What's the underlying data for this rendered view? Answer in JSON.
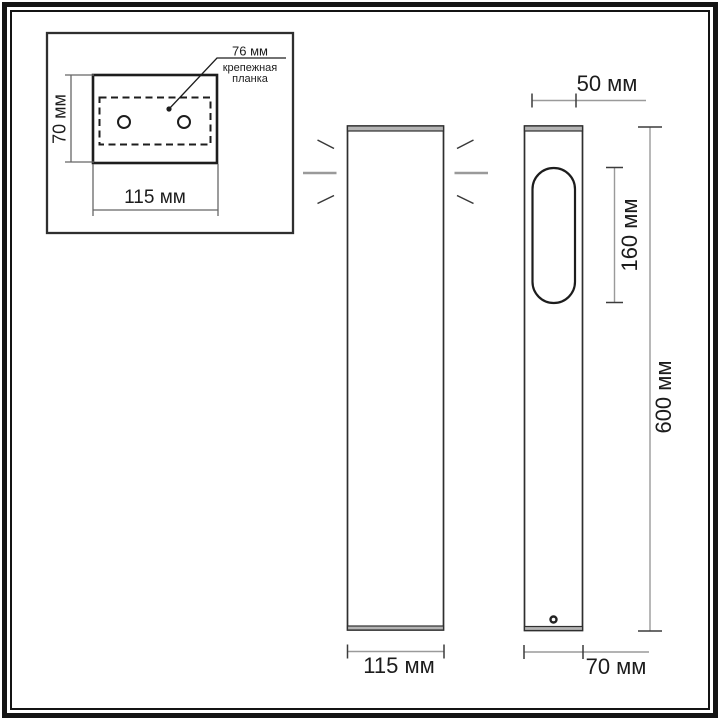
{
  "colors": {
    "line_dark": "#2f2f2f",
    "line_grey": "#9a9a9a",
    "fill_grey": "#b4b4b4",
    "frame": "#141414",
    "text": "#1c1c1c",
    "bg": "#ffffff"
  },
  "inset": {
    "hole_spacing": "76 мм",
    "plate_label": "крепежная планка",
    "plate_height": "70 мм",
    "plate_width": "115 мм"
  },
  "front_view": {
    "width": "115 мм"
  },
  "side_view": {
    "top_depth": "50 мм",
    "window_height": "160 мм",
    "total_height": "600 мм",
    "depth": "70 мм"
  }
}
